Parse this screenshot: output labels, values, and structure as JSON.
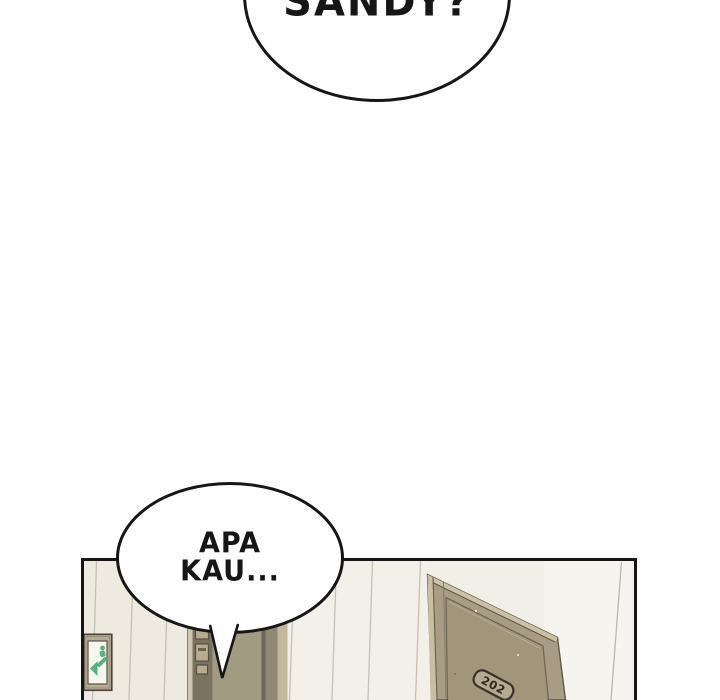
{
  "comic": {
    "top_speech_bubble": {
      "text": "SANDY?"
    },
    "bottom_speech_bubble": {
      "line1": "APA",
      "line2": "KAU..."
    },
    "hallway_panel": {
      "room_door_plate": "202",
      "exit_sign_icon": "exit-running-man-arrow-icon"
    },
    "colors": {
      "outline": "#161616",
      "wall": "#f2efe8",
      "wall_line": "#c6c0b4",
      "door_face": "#a89d84",
      "door_dark_strip": "#7b7362",
      "door_trim_light": "#c9bea2",
      "exit_sign_green": "#55b181",
      "room_plate_fill": "#b5aa8d"
    }
  }
}
